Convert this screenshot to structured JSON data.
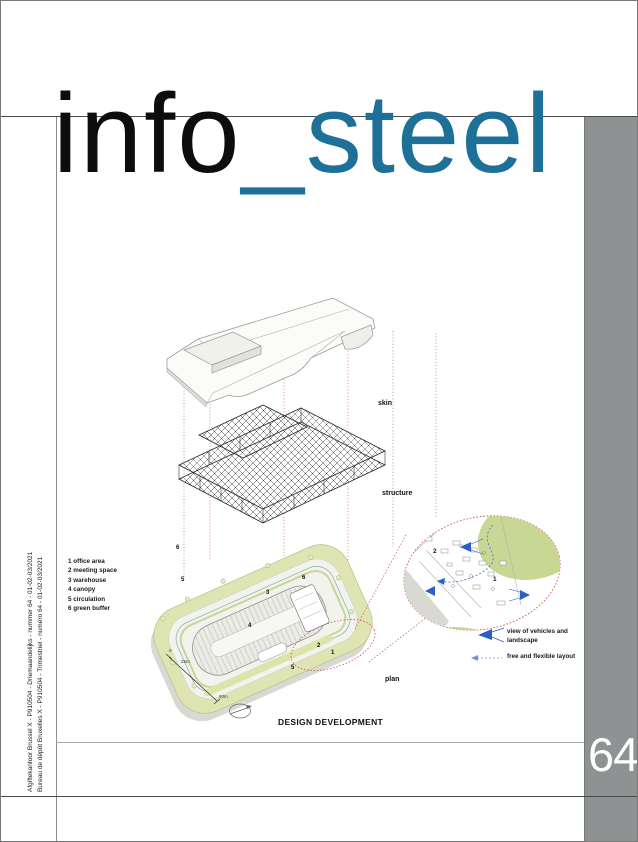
{
  "masthead": {
    "word_black": "info",
    "word_accent": "_steel"
  },
  "issue": {
    "number": "64"
  },
  "spine": {
    "line1": "Afgiftekantoor Brussel X - P910504 - Driemaandelijks - nummer 64 - 01-02-03/2021",
    "line2": "Bureau de dépôt Bruxelles X - P910504 - Trimestriel - numéro 64 - 01-02-03/2021"
  },
  "diagram": {
    "caption": "DESIGN DEVELOPMENT",
    "layer_labels": {
      "skin": "skin",
      "structure": "structure",
      "plan": "plan"
    },
    "legend": {
      "items": [
        "1 office area",
        "2 meeting space",
        "3 warehouse",
        "4 canopy",
        "5 circulation",
        "6 green buffer"
      ]
    },
    "plan_markers": [
      {
        "label": "6"
      },
      {
        "label": "5"
      },
      {
        "label": "3"
      },
      {
        "label": "6"
      },
      {
        "label": "4"
      },
      {
        "label": "2"
      },
      {
        "label": "1"
      },
      {
        "label": "5"
      }
    ],
    "detail_markers": [
      {
        "label": "2"
      },
      {
        "label": "1"
      }
    ],
    "scale_bar": {
      "start": "0",
      "mid": "25m",
      "end": "50m"
    },
    "annotations": [
      {
        "label": "view of vehicles and landscape"
      },
      {
        "label": "free and flexible layout"
      }
    ],
    "colors": {
      "accent_teal": "#1e7098",
      "red_dashed": "#cc5555",
      "plan_green": "#dfe5b2",
      "detail_green": "#c9d794",
      "arrow_blue": "#2b5fc7",
      "strip_gray": "#8e9292"
    }
  }
}
